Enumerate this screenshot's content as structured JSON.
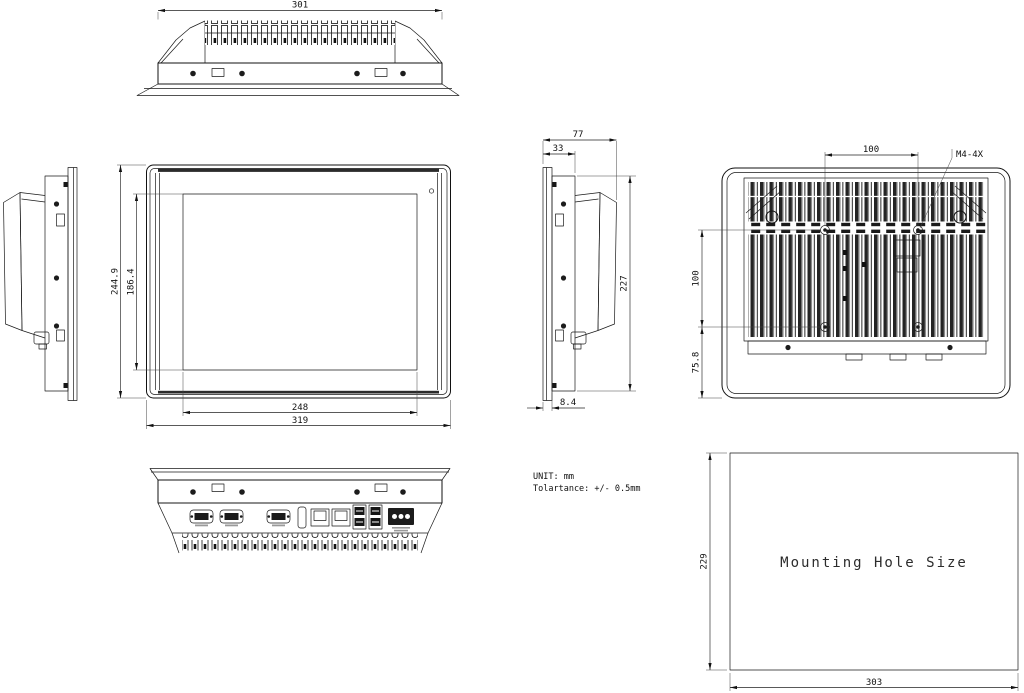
{
  "notes": {
    "unit": "UNIT: mm",
    "tolerance": "Tolartance: +/- 0.5mm"
  },
  "dimensions": {
    "top_view": {
      "overall_width": "301"
    },
    "front_view": {
      "overall_height": "244.9",
      "display_height": "186.4",
      "display_width": "248",
      "overall_width": "319"
    },
    "side_view": {
      "overall_depth": "77",
      "chassis_depth": "33",
      "chassis_height": "227",
      "bezel_protrusion": "8.4"
    },
    "rear_view": {
      "vesa_width": "100",
      "vesa_height": "100",
      "lower_hole_offset": "75.8",
      "screw_spec": "M4-4X"
    },
    "mounting_hole": {
      "caption": "Mounting Hole Size",
      "cutout_width": "303",
      "cutout_height": "229"
    }
  }
}
